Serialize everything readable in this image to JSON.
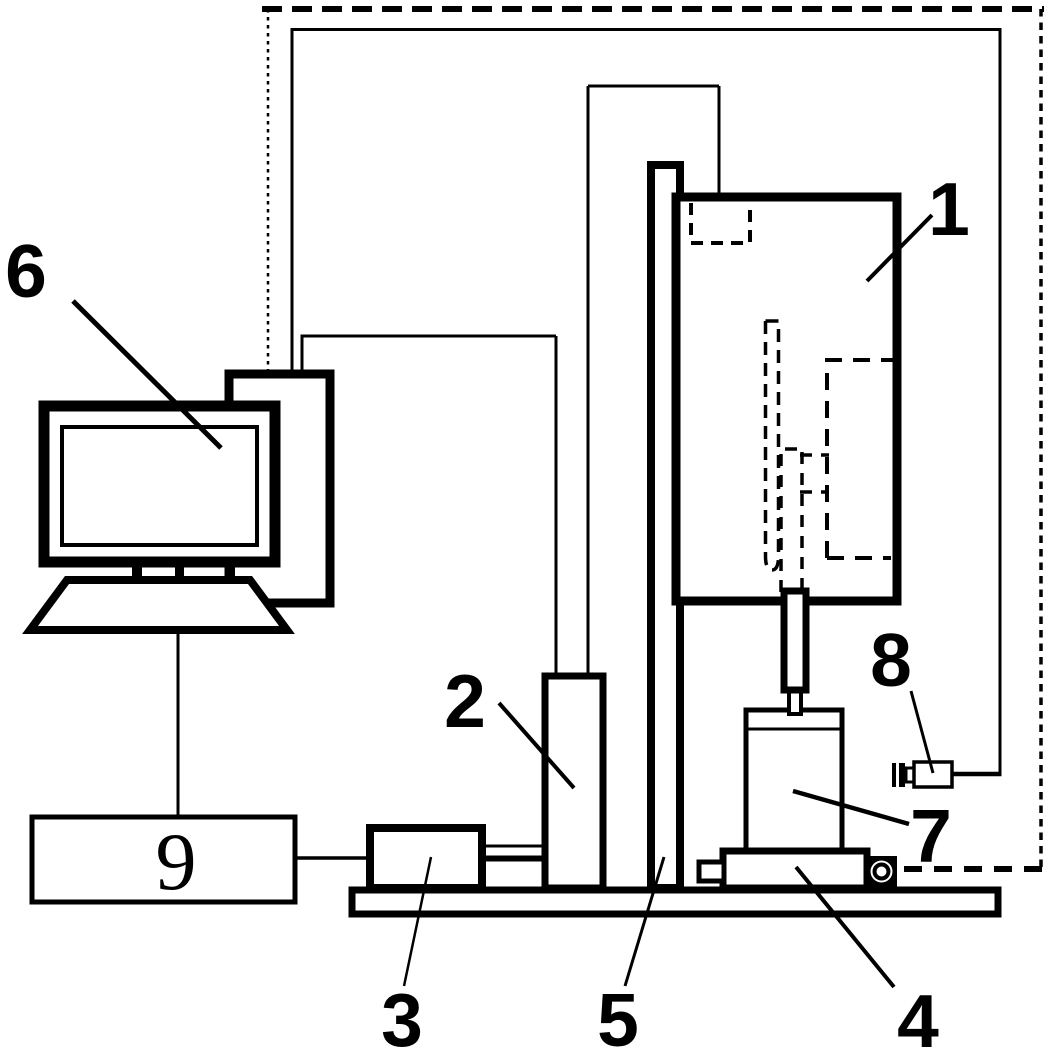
{
  "figure": {
    "background_color": "#ffffff",
    "line_color": "#000000",
    "labels": [
      "1",
      "2",
      "3",
      "4",
      "5",
      "6",
      "7",
      "8",
      "9"
    ]
  }
}
